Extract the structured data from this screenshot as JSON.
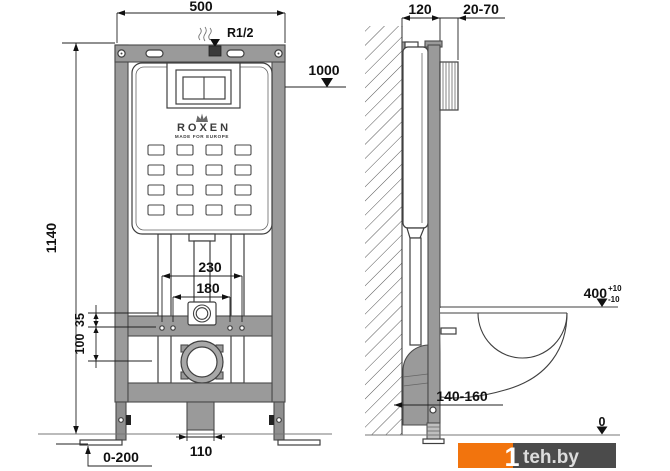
{
  "colors": {
    "frame_gray": "#9a9a9a",
    "outline": "#3f3f3f",
    "accent_orange": "#f2740d",
    "watermark_dark": "#4b4b4b",
    "dimension_text": "#111111"
  },
  "front_view": {
    "width_label": "500",
    "height_label": "1140",
    "supply_label": "R1/2",
    "ref_height_label": "1000",
    "bolt_spacing_outer_label": "230",
    "bolt_spacing_inner_label": "180",
    "offset_small_label": "35",
    "offset_large_label": "100",
    "bracket_width_label": "110",
    "leg_adjust_label": "0-200",
    "brand_name": "ROXEN",
    "brand_tagline": "MADE FOR EUROPE"
  },
  "side_view": {
    "depth_label": "120",
    "finish_thickness_label": "20-70",
    "bowl_height_label": "400",
    "bowl_height_tol_plus": "+10",
    "bowl_height_tol_minus": "-10",
    "outlet_range_label": "140-160",
    "floor_zero_label": "0"
  },
  "watermark": {
    "prefix": "1",
    "site": "teh.by"
  }
}
